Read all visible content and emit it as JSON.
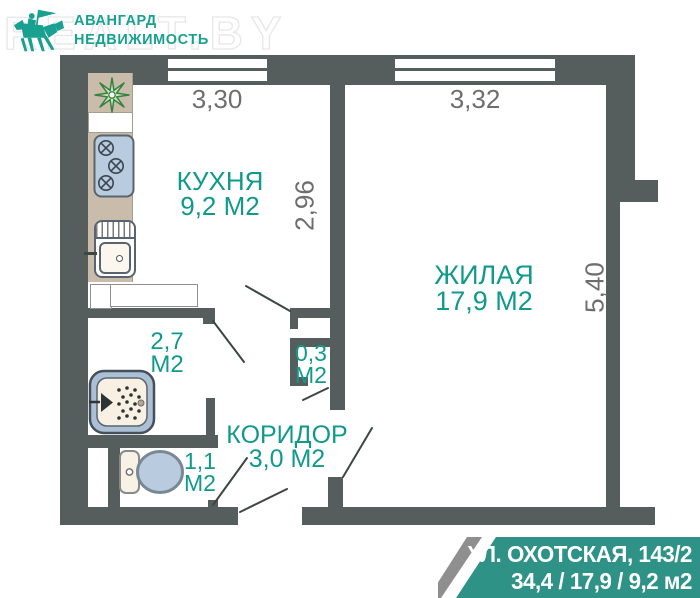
{
  "logo": {
    "watermark": "REALT.BY",
    "name_line1": "АВАНГАРД",
    "name_line2": "НЕДВИЖИМОСТЬ"
  },
  "rooms": {
    "kitchen": {
      "name": "КУХНЯ",
      "area": "9,2 М2"
    },
    "living": {
      "name": "ЖИЛАЯ",
      "area": "17,9 М2"
    },
    "corridor": {
      "name": "КОРИДОР",
      "area": "3,0 М2"
    },
    "bathroom": {
      "area": "2,7",
      "unit": "М2"
    },
    "toilet": {
      "area": "1,1",
      "unit": "М2"
    },
    "closet": {
      "area": "0,3",
      "unit": "М2"
    }
  },
  "dimensions": {
    "kitchen_width": "3,30",
    "living_width": "3,32",
    "kitchen_depth": "2,96",
    "living_depth": "5,40"
  },
  "banner": {
    "address": "УЛ. ОХОТСКАЯ, 143/2",
    "areas": "34,4 / 17,9 / 9,2 м2"
  },
  "icons": {
    "logo": "horse-flag-icon",
    "kitchen_vent": "vent-flower-icon",
    "stove": "stove-icon",
    "sink": "sink-icon",
    "bathtub": "bathtub-icon",
    "toilet": "toilet-icon"
  },
  "colors": {
    "wall": "#565E5D",
    "accent": "#119A8B",
    "banner": "#2E9286",
    "dim": "#6E6E6E",
    "beige": "#C9BCAA",
    "fixture_blue": "#B9CCDF"
  }
}
